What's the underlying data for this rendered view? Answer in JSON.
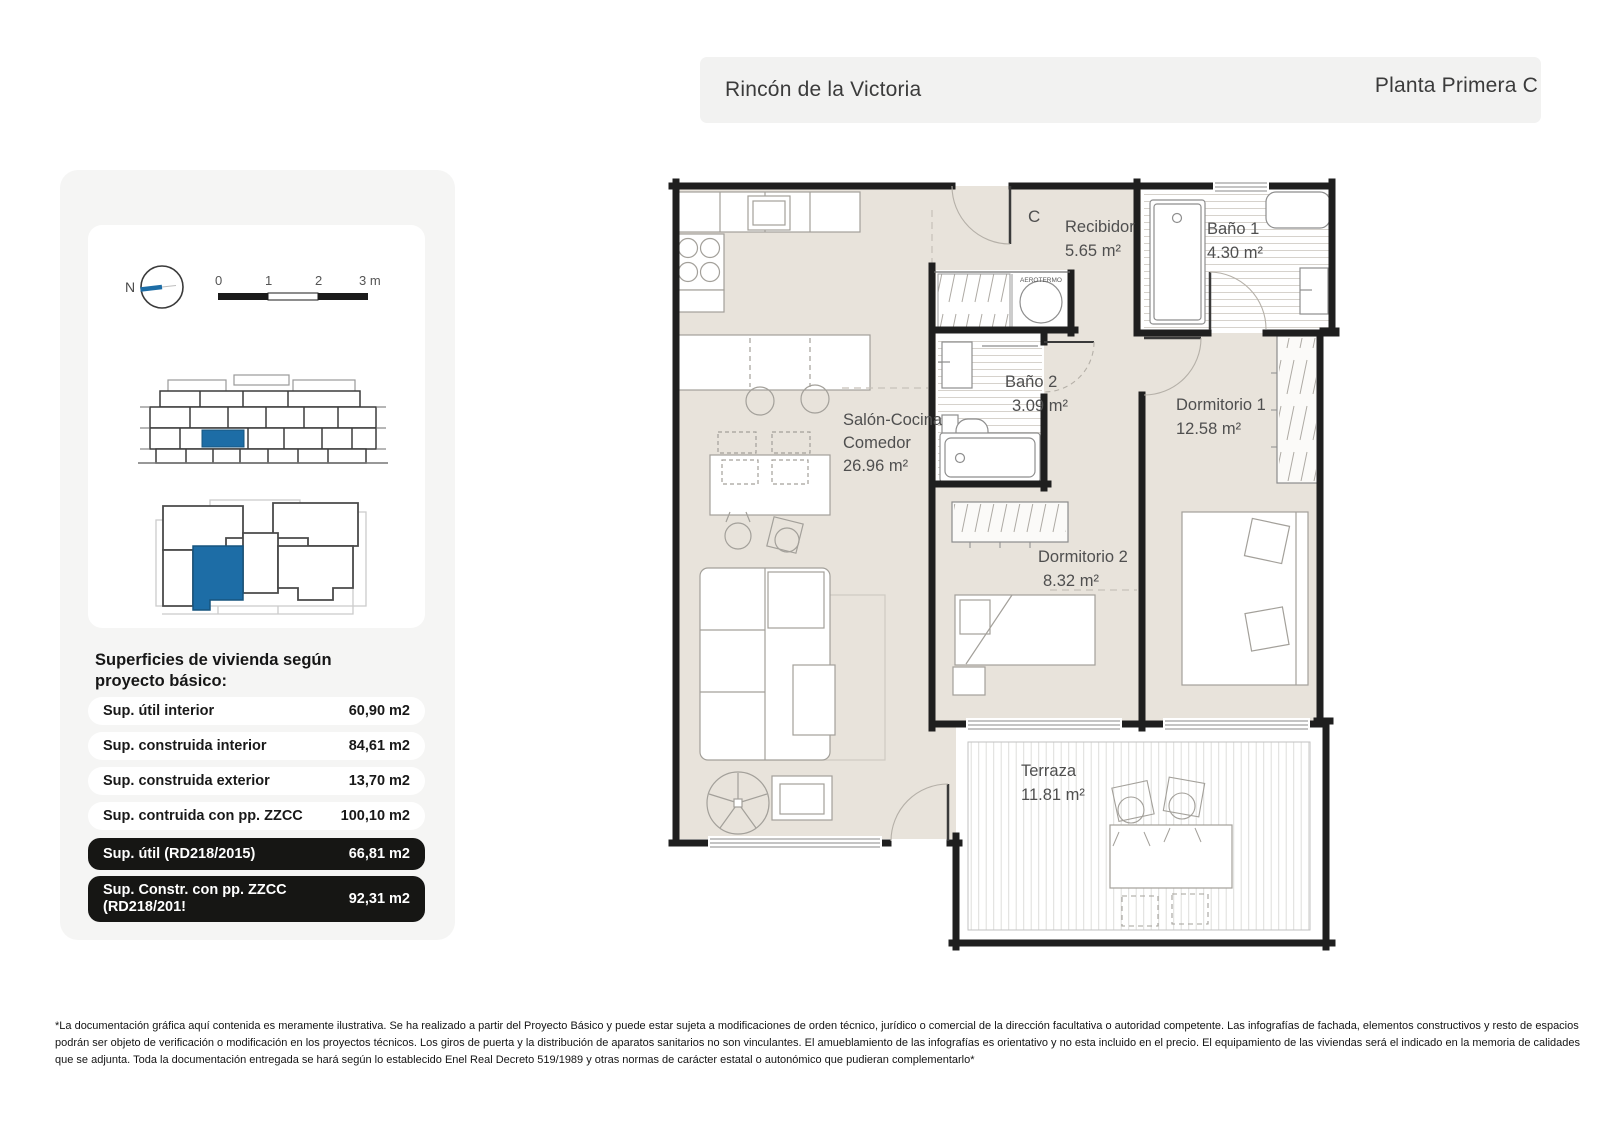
{
  "header": {
    "location": "Rincón de la Victoria",
    "plan_title": "Planta Primera C"
  },
  "sidebar": {
    "compass_label": "N",
    "scale_ticks": [
      "0",
      "1",
      "2",
      "3 m"
    ],
    "surfaces": {
      "title_line1": "Superficies de vivienda según",
      "title_line2": "proyecto básico:",
      "rows": [
        {
          "label": "Sup. útil interior",
          "value": "60,90 m2"
        },
        {
          "label": "Sup. construida interior",
          "value": "84,61 m2"
        },
        {
          "label": "Sup. construida exterior",
          "value": "13,70 m2"
        },
        {
          "label": "Sup. contruida con pp. ZZCC",
          "value": "100,10 m2"
        },
        {
          "label": "Sup. útil (RD218/2015)",
          "value": "66,81 m2"
        },
        {
          "label": "Sup. Constr. con pp. ZZCC",
          "label_line2": "(RD218/201!",
          "value": "92,31 m2"
        }
      ]
    }
  },
  "plan": {
    "unit_letter": "C",
    "equipment_label": "AEROTERMO",
    "rooms": [
      {
        "name": "Recibidor",
        "area": "5.65 m²"
      },
      {
        "name": "Baño 1",
        "area": "4.30 m²"
      },
      {
        "name": "Baño 2",
        "area": "3.09 m²"
      },
      {
        "name": "Salón-Cocina",
        "name2": "Comedor",
        "area": "26.96 m²"
      },
      {
        "name": "Dormitorio 1",
        "area": "12.58 m²"
      },
      {
        "name": "Dormitorio 2",
        "area": "8.32 m²"
      },
      {
        "name": "Terraza",
        "area": "11.81 m²"
      }
    ]
  },
  "footer": {
    "lines": [
      "*La documentación gráfica aquí contenida es meramente ilustrativa. Se ha realizado a partir del Proyecto Básico y puede estar sujeta a modificaciones de orden técnico, jurídico o comercial de la dirección facultativa o autoridad competente. Las infografías de fachada, elementos constructivos y resto de espacios",
      "podrán ser objeto de verificación o modificación en los proyectos técnicos. Los giros de puerta y la distribución de aparatos sanitarios no son vinculantes. El amueblamiento de las infografías es orientativo y no esta incluido en el precio. El equipamiento de las viviendas será el indicado en la memoria de calidades",
      "que se adjunta. Toda la documentación entregada se hará según lo establecido Enel Real Decreto 519/1989 y otras normas de carácter estatal o autonómico que pudieran complementarlo*"
    ]
  },
  "colors": {
    "accent_blue": "#1d6da6",
    "floor_beige": "#e8e3db",
    "wall": "#1f1f1f"
  }
}
